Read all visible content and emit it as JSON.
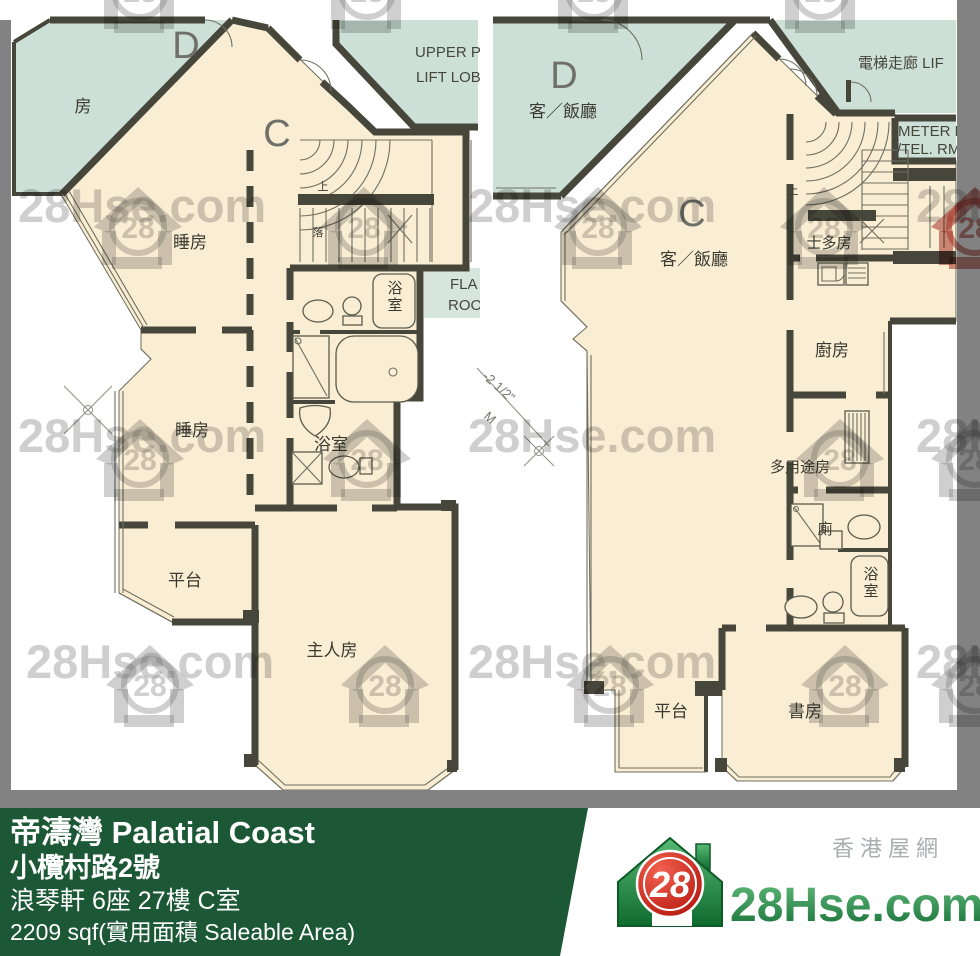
{
  "watermark": {
    "text": "28Hse.com",
    "badge": "28"
  },
  "plans": [
    {
      "id": "lower-floor",
      "labels": [
        {
          "text": "D"
        },
        {
          "text": "房"
        },
        {
          "text": "C"
        },
        {
          "text": "UPPER P"
        },
        {
          "text": "LIFT LOB"
        },
        {
          "text": "睡房"
        },
        {
          "text": "上"
        },
        {
          "text": "落"
        },
        {
          "text": "浴室"
        },
        {
          "text": "FLA"
        },
        {
          "text": "ROO"
        },
        {
          "text": "睡房"
        },
        {
          "text": "浴室"
        },
        {
          "text": "平台"
        },
        {
          "text": "主人房"
        }
      ]
    },
    {
      "id": "upper-floor",
      "labels": [
        {
          "text": "D"
        },
        {
          "text": "客／飯廳"
        },
        {
          "text": "電梯走廊 LIF"
        },
        {
          "text": "METER R"
        },
        {
          "text": "/TEL. RM"
        },
        {
          "text": "C"
        },
        {
          "text": "客／飯廳"
        },
        {
          "text": "上"
        },
        {
          "text": "士多房"
        },
        {
          "text": "廚房"
        },
        {
          "text": "多用途房"
        },
        {
          "text": "廁"
        },
        {
          "text": "浴室"
        },
        {
          "text": "平台"
        },
        {
          "text": "書房"
        }
      ]
    }
  ],
  "annotations": {
    "dim_line_1": "-2 1/2\"",
    "dim_line_2": "M"
  },
  "footer": {
    "estate": "帝濤灣 Palatial Coast",
    "address": "小欖村路2號",
    "unit": "浪琴軒 6座 27樓 C室",
    "area": "2209 sqf(實用面積 Saleable Area)",
    "logo": {
      "badge": "28",
      "site_name": "28Hse.com",
      "tagline": "香港屋網"
    }
  }
}
